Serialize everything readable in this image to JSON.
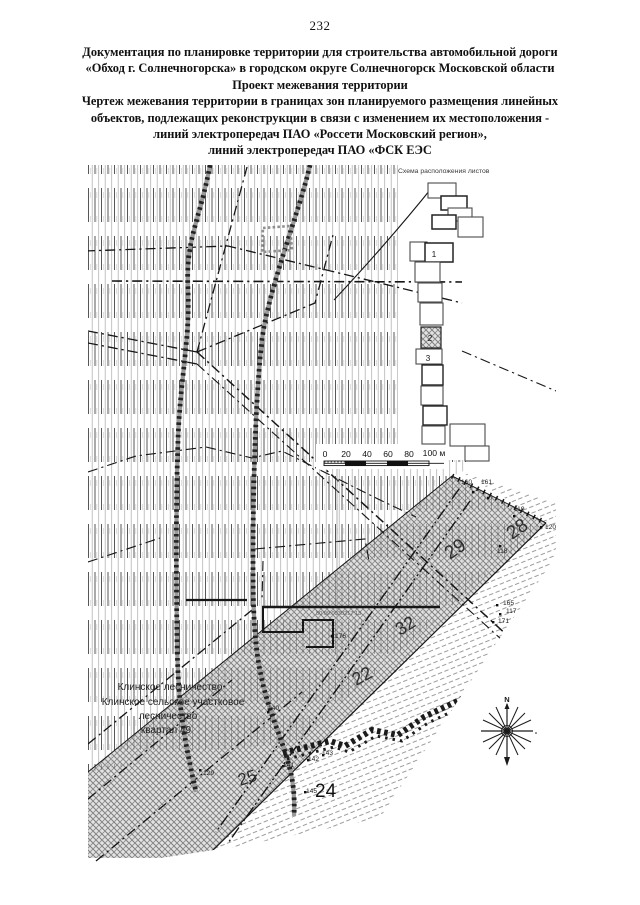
{
  "page": {
    "number": "232"
  },
  "header": {
    "lines": [
      "Документация по планировке территории для строительства автомобильной дороги",
      "«Обход г. Солнечногорска» в городском округе Солнечногорск Московской области",
      "Проект межевания территории",
      "Чертеж межевания территории в границах зон планируемого размещения линейных",
      "объектов, подлежащих реконструкции в связи с изменением их местоположения -",
      "линий электропередач ПАО «Россети Московский регион»,",
      "линий электропередач ПАО «ФСК ЕЭС"
    ]
  },
  "sheet_scheme": {
    "title": "Схема расположения листов",
    "sheet_labels": [
      "1",
      "2",
      "3"
    ]
  },
  "scale_bar": {
    "ticks": [
      "0",
      "20",
      "40",
      "60",
      "80",
      "100 м"
    ]
  },
  "compass": {
    "north_label": "N"
  },
  "map": {
    "forest_label_lines": [
      "Клинское лесничество",
      "Клинское сельское участковое",
      "лесничество",
      "квартал 49"
    ],
    "cadastral_number": "50:09:0030217:13",
    "area_numbers": [
      {
        "label": "28"
      },
      {
        "label": "29"
      },
      {
        "label": "32"
      },
      {
        "label": "22"
      },
      {
        "label": "25"
      },
      {
        "label": "24"
      }
    ],
    "point_labels": [
      {
        "label": "160"
      },
      {
        "label": "161"
      },
      {
        "label": "119"
      },
      {
        "label": "120"
      },
      {
        "label": "118"
      },
      {
        "label": "165"
      },
      {
        "label": "117"
      },
      {
        "label": "171"
      },
      {
        "label": "176"
      },
      {
        "label": "129"
      },
      {
        "label": "140"
      },
      {
        "label": "141"
      },
      {
        "label": "142"
      },
      {
        "label": "143"
      },
      {
        "label": "145"
      }
    ]
  }
}
